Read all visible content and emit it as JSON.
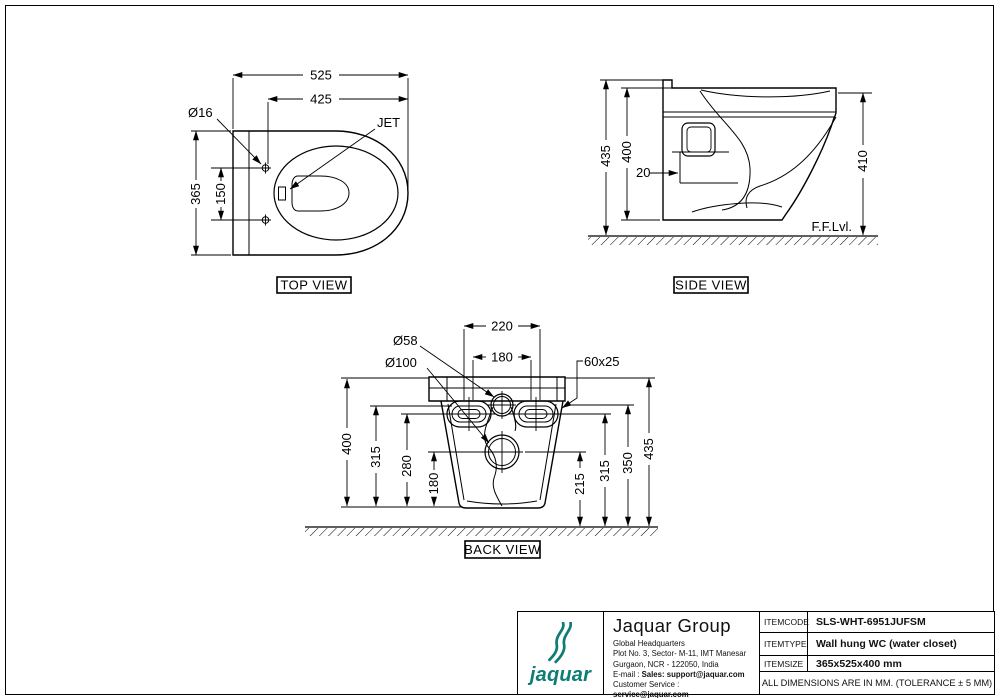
{
  "views": {
    "top": {
      "label": "TOP VIEW",
      "dim_overall_depth": "525",
      "dim_front_to_holes": "425",
      "hole_dia": "Ø16",
      "jet_label": "JET",
      "dim_width": "365",
      "dim_hole_spacing": "150"
    },
    "side": {
      "label": "SIDE VIEW",
      "dim_total_height": "435",
      "dim_body_height": "400",
      "dim_wall_offset": "20",
      "dim_rim_height": "410",
      "floor_label": "F.F.Lvl."
    },
    "back": {
      "label": "BACK VIEW",
      "dim_slot_span": "220",
      "dim_inner_span": "180",
      "inlet_dia": "Ø58",
      "outlet_dia": "Ø100",
      "slot_size": "60x25",
      "dim_left_400": "400",
      "dim_left_315": "315",
      "dim_left_280": "280",
      "dim_left_180": "180",
      "dim_right_215": "215",
      "dim_right_315": "315",
      "dim_right_350": "350",
      "dim_right_435": "435"
    }
  },
  "title_block": {
    "brand_color": "#0d7d76",
    "logo_text": "jaquar",
    "company_name": "Jaquar Group",
    "address_lines": [
      "Global Headquarters",
      "Plot No. 3, Sector- M-11, IMT Manesar",
      "Gurgaon, NCR - 122050, India"
    ],
    "email_prefix": "E-mail : ",
    "email_bold": "Sales: support@jaquar.com",
    "service_prefix": "Customer Service : ",
    "service_bold": "service@jaquar.com",
    "rows": [
      {
        "label_a": "ITEM",
        "label_b": "CODE",
        "value": "SLS-WHT-6951JUFSM"
      },
      {
        "label_a": "ITEM",
        "label_b": "TYPE",
        "value": "Wall hung WC (water closet)"
      },
      {
        "label_a": "ITEM",
        "label_b": "SIZE",
        "value": "365x525x400 mm"
      }
    ],
    "note": "ALL DIMENSIONS ARE IN MM. (TOLERANCE ± 5 MM)"
  }
}
